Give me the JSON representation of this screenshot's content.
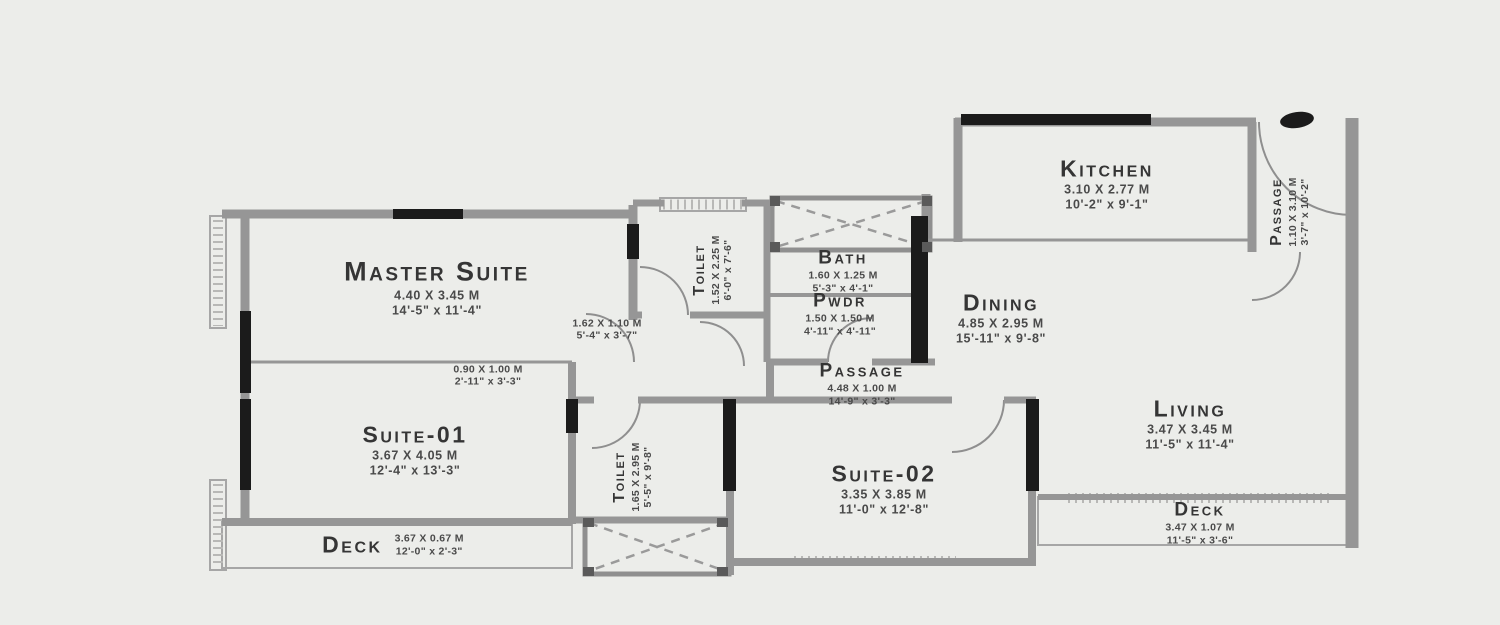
{
  "plan": {
    "title": "Apartment Floor Plan",
    "colors": {
      "background": "#ecedea",
      "wall_gray": "#969696",
      "wall_black": "#1b1b1b",
      "text": "#3a3a3a"
    },
    "rooms": {
      "master_suite": {
        "name": "Master Suite",
        "metric": "4.40 X 3.45 M",
        "imperial": "14'-5\" x 11'-4\""
      },
      "toilet_top": {
        "name": "Toilet",
        "metric": "1.52 X 2.25 M",
        "imperial": "6'-0\" x 7'-6\""
      },
      "bath": {
        "name": "Bath",
        "metric": "1.60 X 1.25 M",
        "imperial": "5'-3\" x 4'-1\""
      },
      "pwdr": {
        "name": "Pwdr",
        "metric": "1.50 X 1.50 M",
        "imperial": "4'-11\" x 4'-11\""
      },
      "kitchen": {
        "name": "Kitchen",
        "metric": "3.10 X 2.77 M",
        "imperial": "10'-2\" x 9'-1\""
      },
      "passage_right": {
        "name": "Passage",
        "metric": "1.10 X 3.10 M",
        "imperial": "3'-7\" x 10'-2\""
      },
      "dining": {
        "name": "Dining",
        "metric": "4.85 X 2.95 M",
        "imperial": "15'-11\" x 9'-8\""
      },
      "passage_center": {
        "name": "Passage",
        "metric": "4.48 X 1.00 M",
        "imperial": "14'-9\" x 3'-3\""
      },
      "lobby_dim": {
        "metric": "1.62 X 1.10 M",
        "imperial": "5'-4\" x 3'-7\""
      },
      "entry_dim": {
        "metric": "0.90 X 1.00 M",
        "imperial": "2'-11\" x 3'-3\""
      },
      "suite_01": {
        "name": "Suite-01",
        "metric": "3.67 X 4.05 M",
        "imperial": "12'-4\" x 13'-3\""
      },
      "toilet_bottom": {
        "name": "Toilet",
        "metric": "1.65 X 2.95 M",
        "imperial": "5'-5\" x 9'-8\""
      },
      "suite_02": {
        "name": "Suite-02",
        "metric": "3.35 X 3.85 M",
        "imperial": "11'-0\" x 12'-8\""
      },
      "living": {
        "name": "Living",
        "metric": "3.47 X 3.45 M",
        "imperial": "11'-5\" x 11'-4\""
      },
      "deck_left": {
        "name": "Deck",
        "metric": "3.67 X 0.67 M",
        "imperial": "12'-0\" x 2'-3\""
      },
      "deck_right": {
        "name": "Deck",
        "metric": "3.47 X 1.07 M",
        "imperial": "11'-5\" x 3'-6\""
      }
    }
  }
}
